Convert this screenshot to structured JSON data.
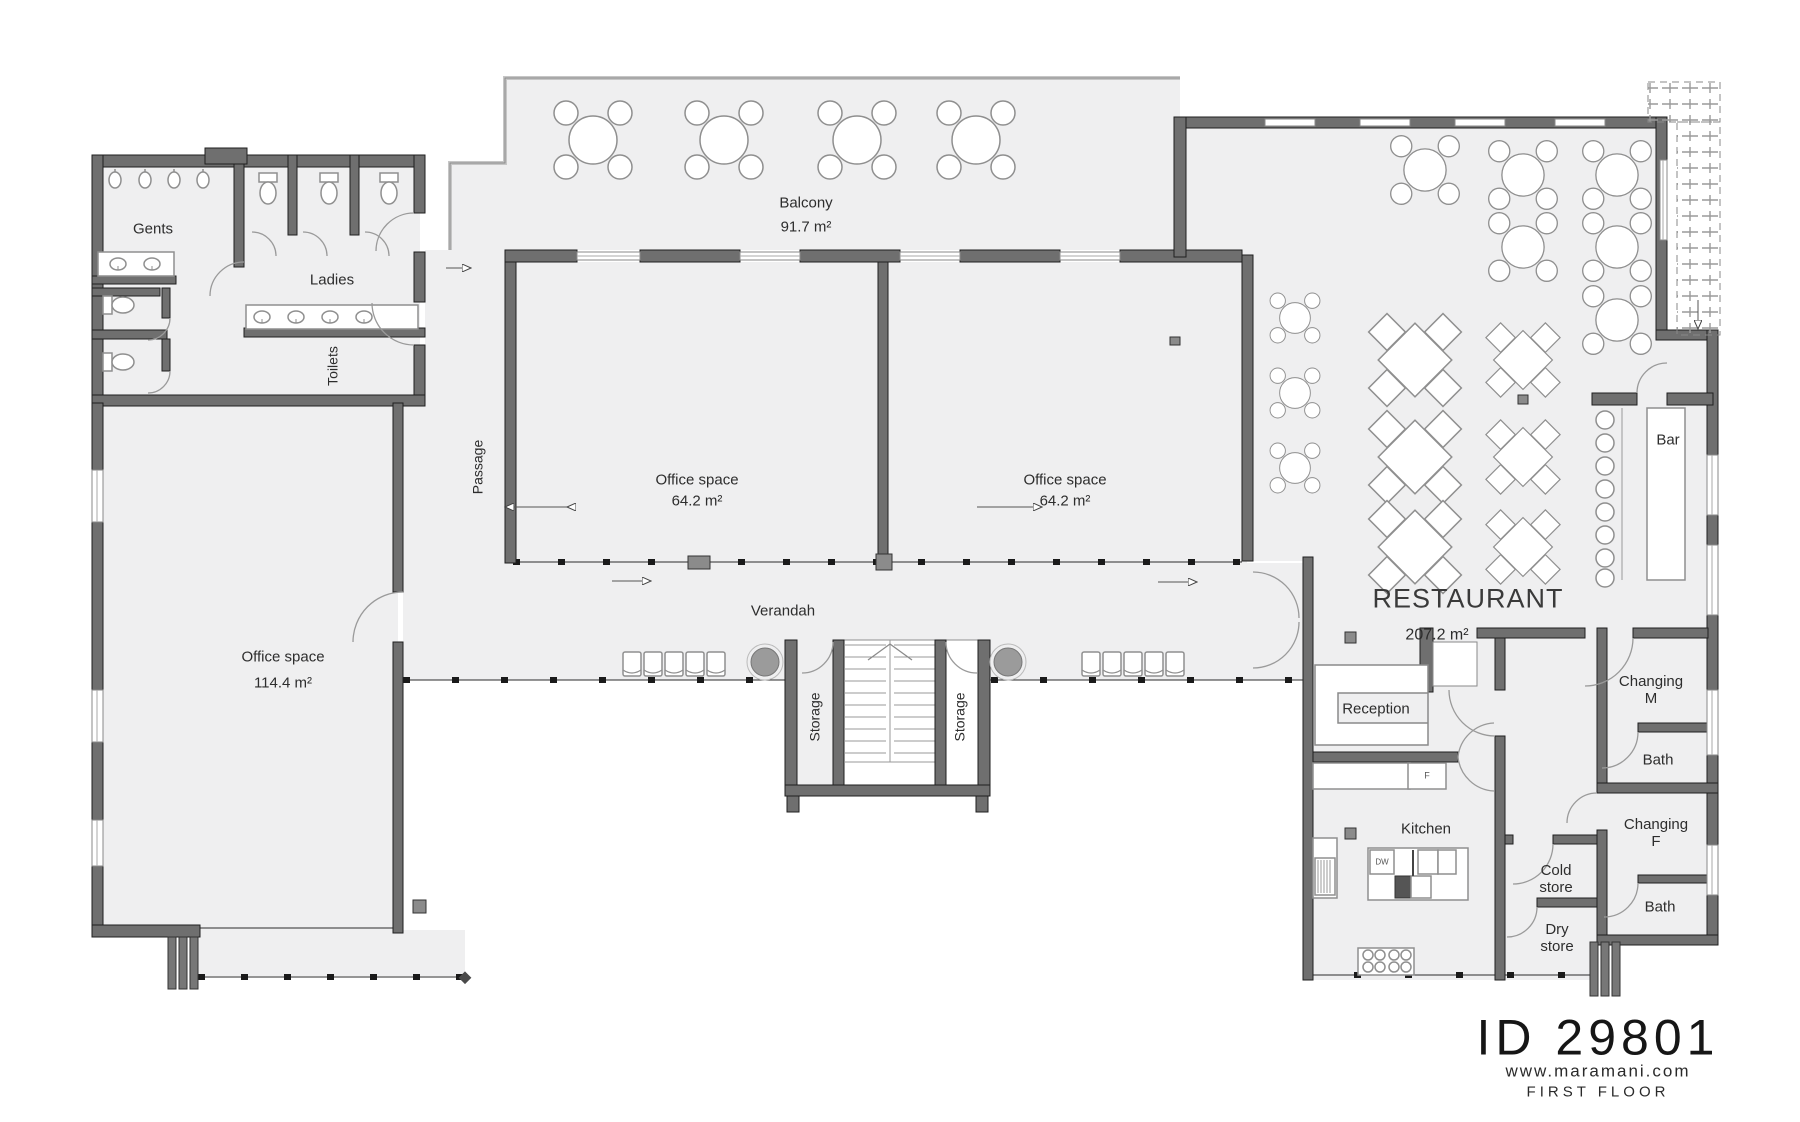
{
  "meta": {
    "plan_id": "ID 29801",
    "website": "www.maramani.com",
    "floor": "FIRST FLOOR"
  },
  "rooms": {
    "gents": {
      "label": "Gents"
    },
    "ladies": {
      "label": "Ladies"
    },
    "toilets": {
      "label": "Toilets"
    },
    "passage": {
      "label": "Passage"
    },
    "balcony": {
      "label": "Balcony",
      "area": "91.7 m²"
    },
    "office_left": {
      "label": "Office space",
      "area": "114.4 m²"
    },
    "office_mid": {
      "label": "Office space",
      "area": "64.2 m²"
    },
    "office_right": {
      "label": "Office space",
      "area": "64.2 m²"
    },
    "verandah": {
      "label": "Verandah"
    },
    "storage_left": {
      "label": "Storage"
    },
    "storage_right": {
      "label": "Storage"
    },
    "restaurant": {
      "label": "RESTAURANT",
      "area": "207.2 m²"
    },
    "bar": {
      "label": "Bar"
    },
    "reception": {
      "label": "Reception"
    },
    "kitchen": {
      "label": "Kitchen"
    },
    "cold_store": {
      "line1": "Cold",
      "line2": "store"
    },
    "dry_store": {
      "line1": "Dry",
      "line2": "store"
    },
    "changing_m": {
      "line1": "Changing",
      "line2": "M"
    },
    "bath_m": {
      "label": "Bath"
    },
    "changing_f": {
      "line1": "Changing",
      "line2": "F"
    },
    "bath_f": {
      "label": "Bath"
    }
  },
  "appliances": {
    "dishwasher": "DW",
    "fridge": "F"
  },
  "colors": {
    "wall": "#6f6f6f",
    "floor": "#efeff0",
    "line": "#9a9a9a",
    "text": "#2d2d2d"
  }
}
